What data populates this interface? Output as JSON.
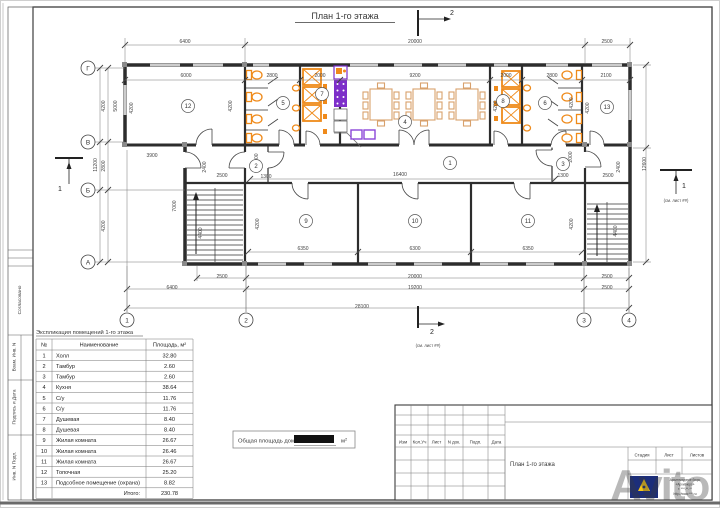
{
  "sheet": {
    "title": "План 1-го этажа"
  },
  "side_stamp": {
    "labels": [
      "Согласовано",
      "Взам. Инв. N",
      "Подпись и Дата",
      "Инв. N Подп."
    ]
  },
  "plan": {
    "grid_rows": [
      "Г",
      "В",
      "Б",
      "А"
    ],
    "grid_cols": [
      "1",
      "2",
      "3",
      "4"
    ],
    "room_numbers": [
      "1",
      "2",
      "3",
      "4",
      "5",
      "6",
      "7",
      "8",
      "9",
      "10",
      "11",
      "12",
      "13"
    ],
    "section_marks": [
      {
        "label": "2",
        "note": ""
      },
      {
        "label": "2",
        "note": "(см. лист ##)"
      },
      {
        "label": "1",
        "note": ""
      },
      {
        "label": "1",
        "note": "(см. лист ##)"
      }
    ],
    "dimensions": [
      {
        "t": "6400",
        "x": 185,
        "y": 43
      },
      {
        "t": "20000",
        "x": 415,
        "y": 43
      },
      {
        "t": "2500",
        "x": 607,
        "y": 43
      },
      {
        "t": "6000",
        "x": 186,
        "y": 77
      },
      {
        "t": "2800",
        "x": 272,
        "y": 77
      },
      {
        "t": "2000",
        "x": 320,
        "y": 77
      },
      {
        "t": "9200",
        "x": 415,
        "y": 77
      },
      {
        "t": "2000",
        "x": 506,
        "y": 77
      },
      {
        "t": "2800",
        "x": 552,
        "y": 77
      },
      {
        "t": "2100",
        "x": 606,
        "y": 77
      },
      {
        "t": "4200",
        "x": 105,
        "y": 106,
        "r": 90
      },
      {
        "t": "5000",
        "x": 117,
        "y": 106,
        "r": 90
      },
      {
        "t": "4200",
        "x": 133,
        "y": 108,
        "r": 90
      },
      {
        "t": "4200",
        "x": 232,
        "y": 106,
        "r": 90
      },
      {
        "t": "4200",
        "x": 497,
        "y": 106,
        "r": 90
      },
      {
        "t": "4200",
        "x": 573,
        "y": 103,
        "r": 90
      },
      {
        "t": "4200",
        "x": 589,
        "y": 108,
        "r": 90
      },
      {
        "t": "11200",
        "x": 97,
        "y": 165,
        "r": 90
      },
      {
        "t": "2800",
        "x": 105,
        "y": 166,
        "r": 90
      },
      {
        "t": "4200",
        "x": 105,
        "y": 226,
        "r": 90
      },
      {
        "t": "3900",
        "x": 152,
        "y": 157
      },
      {
        "t": "2400",
        "x": 206,
        "y": 167,
        "r": 90
      },
      {
        "t": "2500",
        "x": 222,
        "y": 177
      },
      {
        "t": "2000",
        "x": 258,
        "y": 159,
        "r": 90
      },
      {
        "t": "1300",
        "x": 266,
        "y": 178
      },
      {
        "t": "16400",
        "x": 400,
        "y": 176
      },
      {
        "t": "1300",
        "x": 563,
        "y": 177
      },
      {
        "t": "2000",
        "x": 572,
        "y": 157,
        "r": 90
      },
      {
        "t": "2500",
        "x": 608,
        "y": 177
      },
      {
        "t": "2400",
        "x": 620,
        "y": 167,
        "r": 90
      },
      {
        "t": "7000",
        "x": 176,
        "y": 206,
        "r": 90
      },
      {
        "t": "4400",
        "x": 202,
        "y": 233,
        "r": 90
      },
      {
        "t": "4400",
        "x": 617,
        "y": 231,
        "r": 90
      },
      {
        "t": "12600",
        "x": 646,
        "y": 164,
        "r": 90
      },
      {
        "t": "4200",
        "x": 259,
        "y": 224,
        "r": 90
      },
      {
        "t": "4200",
        "x": 573,
        "y": 224,
        "r": 90
      },
      {
        "t": "6350",
        "x": 303,
        "y": 250
      },
      {
        "t": "6300",
        "x": 415,
        "y": 250
      },
      {
        "t": "6350",
        "x": 528,
        "y": 250
      },
      {
        "t": "2500",
        "x": 222,
        "y": 278
      },
      {
        "t": "20000",
        "x": 415,
        "y": 278
      },
      {
        "t": "2500",
        "x": 607,
        "y": 278
      },
      {
        "t": "6400",
        "x": 172,
        "y": 289
      },
      {
        "t": "19200",
        "x": 415,
        "y": 289
      },
      {
        "t": "2500",
        "x": 607,
        "y": 289
      },
      {
        "t": "28100",
        "x": 362,
        "y": 308
      }
    ]
  },
  "explication": {
    "title": "Экспликация помещений 1-го этажа",
    "headers": [
      "№",
      "Наименование",
      "Площадь, м²"
    ],
    "rows": [
      [
        "1",
        "Холл",
        "32.80"
      ],
      [
        "2",
        "Тамбур",
        "2.60"
      ],
      [
        "3",
        "Тамбур",
        "2.60"
      ],
      [
        "4",
        "Кухня",
        "38.64"
      ],
      [
        "5",
        "С/у",
        "11.76"
      ],
      [
        "6",
        "С/у",
        "11.76"
      ],
      [
        "7",
        "Душевая",
        "8.40"
      ],
      [
        "8",
        "Душевая",
        "8.40"
      ],
      [
        "9",
        "Жилая комната",
        "26.67"
      ],
      [
        "10",
        "Жилая комната",
        "26.46"
      ],
      [
        "11",
        "Жилая комната",
        "26.67"
      ],
      [
        "12",
        "Топочная",
        "25.20"
      ],
      [
        "13",
        "Подсобное помещение (охрана)",
        "8.82"
      ]
    ],
    "total_label": "Итого:",
    "total_value": "230.78"
  },
  "total_area": {
    "label": "Общая площадь дома",
    "unit": "м",
    "unit_sup": "2"
  },
  "title_block": {
    "revision_headers": [
      "Изм",
      "Кол.Уч",
      "Лист",
      "N док.",
      "Подп.",
      "Дата"
    ],
    "doc_title": "План 1-го этажа",
    "stage_headers": [
      "Стадия",
      "Лист",
      "Листов"
    ],
    "logo_name": "ArchiBuro",
    "company_lines": [
      "Архитектурное бюро",
      "«АрхиБюро»",
      "т. ***-**-**",
      "http://www.***.ru"
    ]
  },
  "watermark": {
    "text": "Avito"
  },
  "colors": {
    "fixture_orange": "#ef8a1a",
    "equipment_purple": "#7d2fc9",
    "furniture_tan": "#d8a16c",
    "logo_blue": "#1c2e7a",
    "logo_yellow": "#f5c518"
  }
}
